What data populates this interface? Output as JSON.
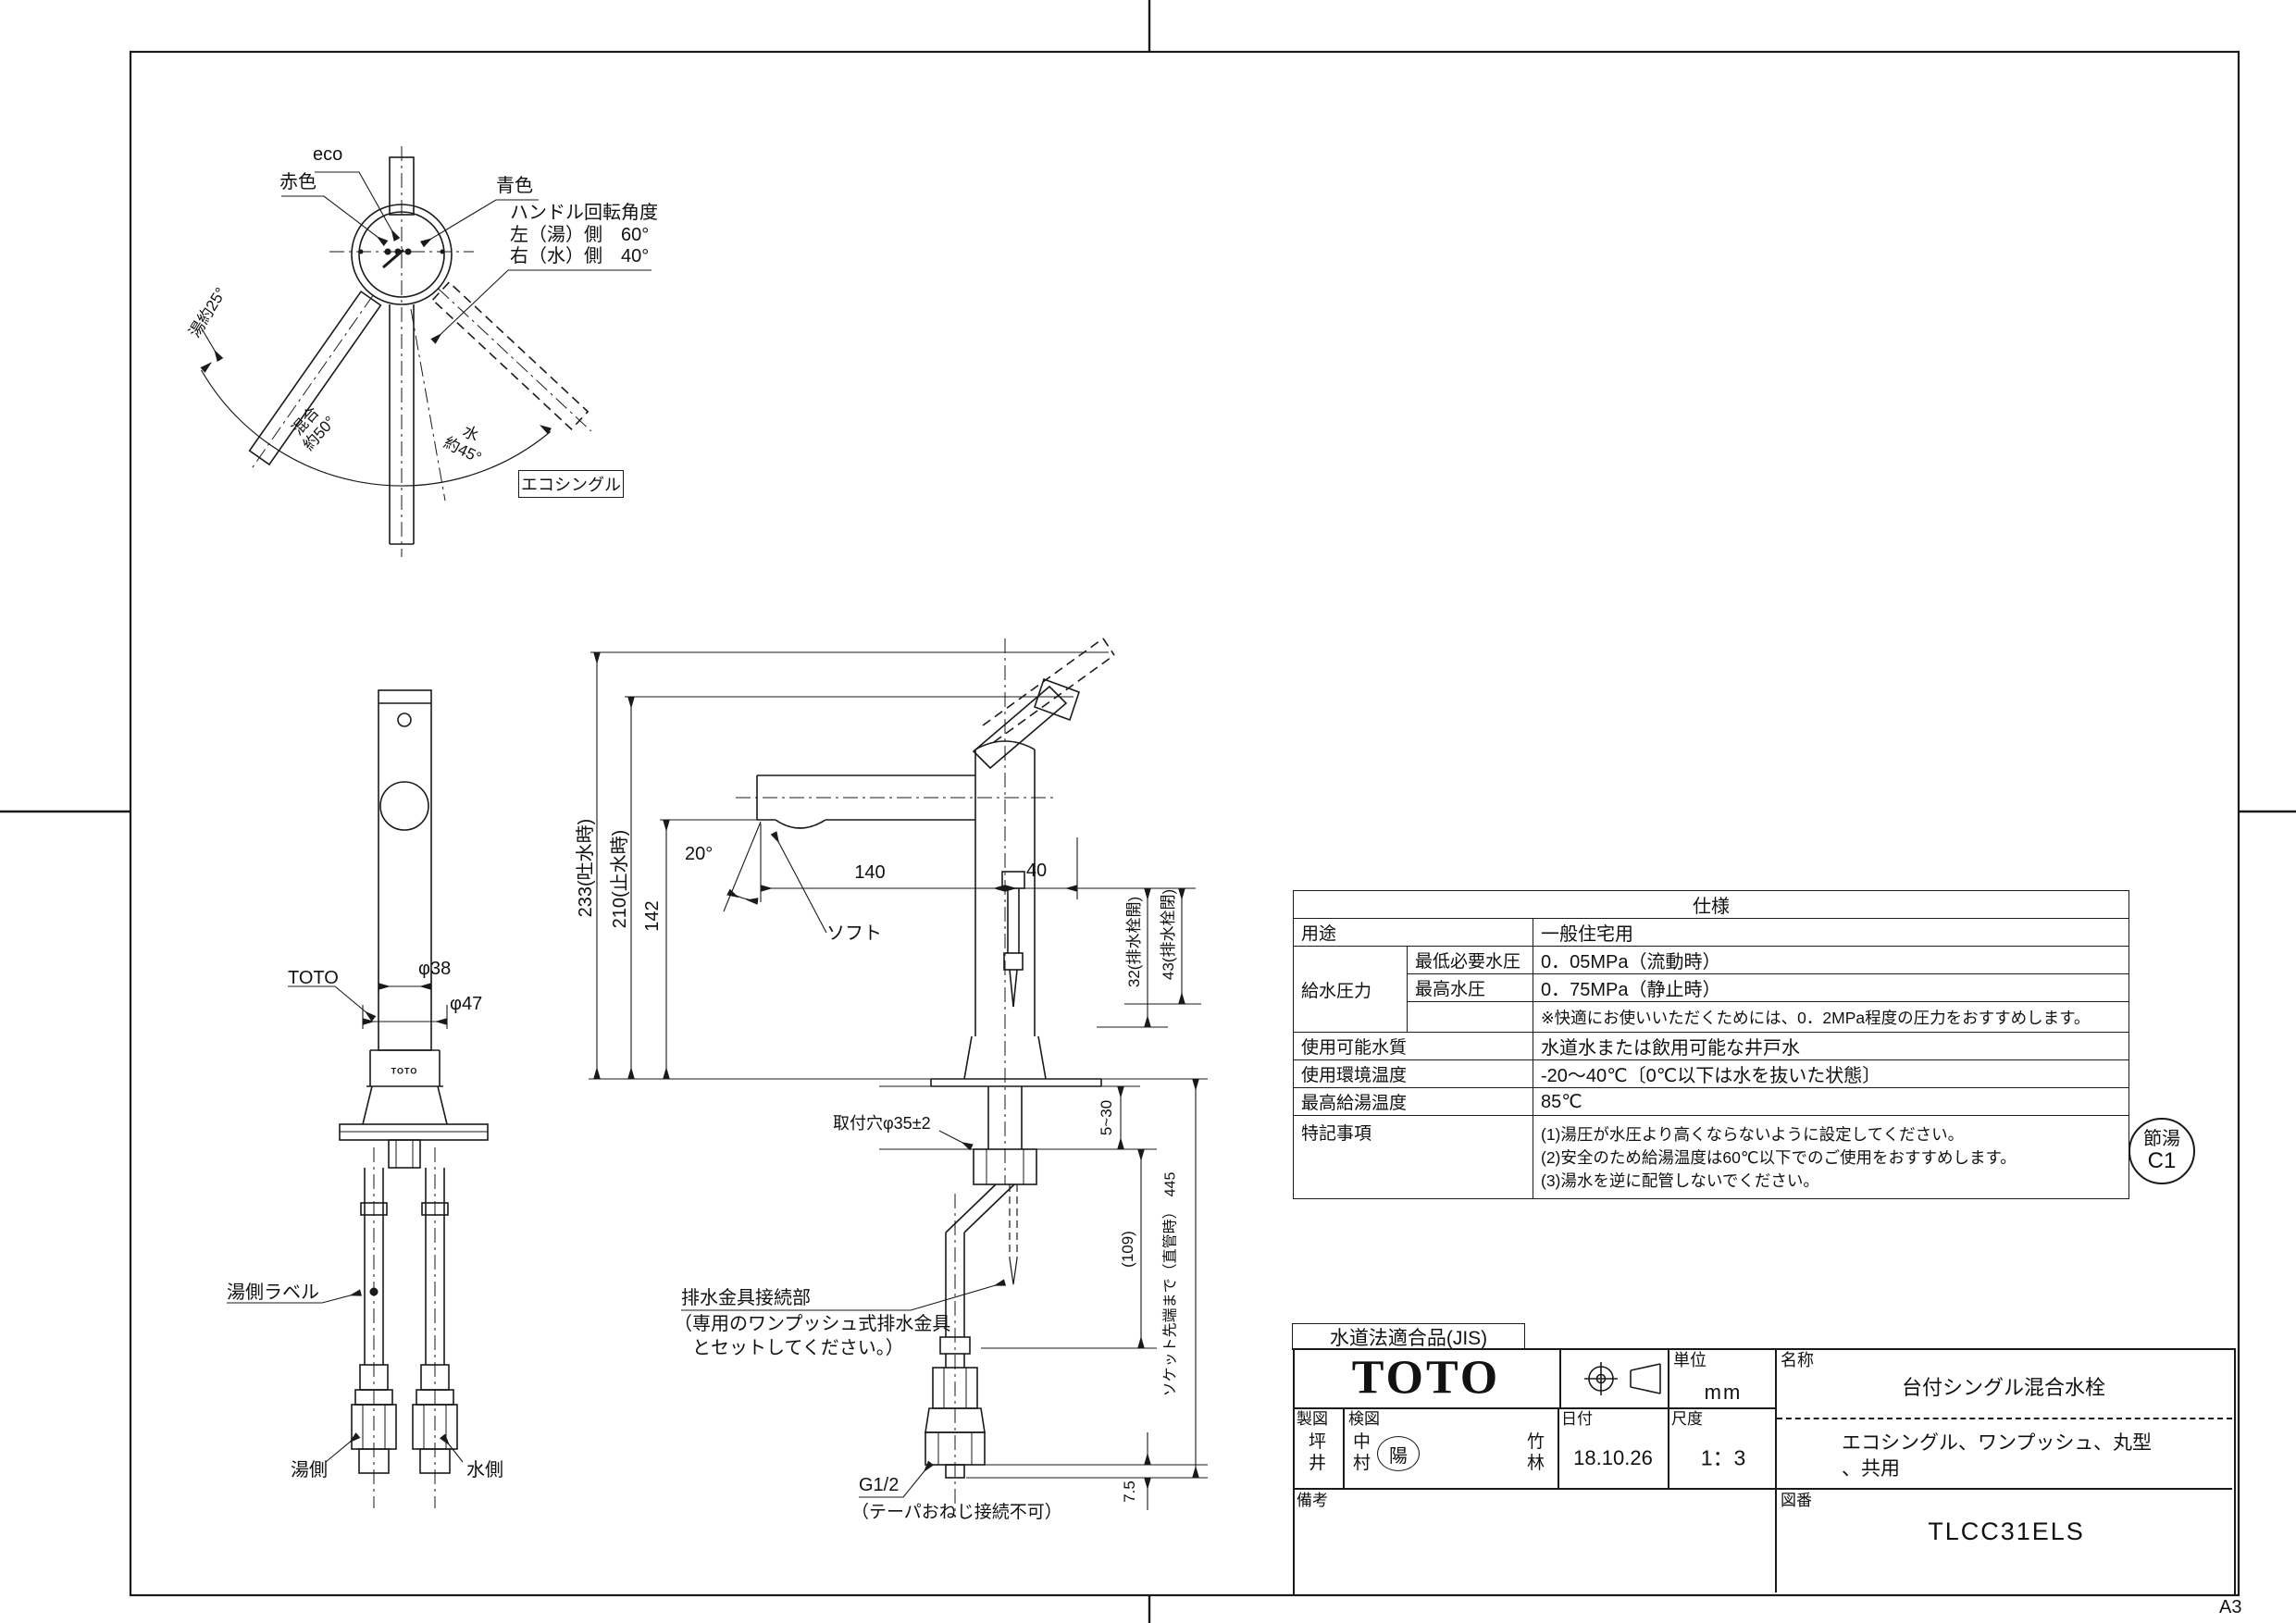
{
  "sheet": {
    "size_label": "A3"
  },
  "handle_diagram": {
    "eco": "eco",
    "red": "赤色",
    "blue": "青色",
    "rotation_title": "ハンドル回転角度",
    "rotation_left": "左（湯）側　60°",
    "rotation_right": "右（水）側　40°",
    "arc_hot": "湯約25°",
    "arc_mix": "混合\n約50°",
    "arc_water": "水\n約45°",
    "mode_box": "エコシングル"
  },
  "front_view": {
    "toto_callout": "TOTO",
    "dia38": "φ38",
    "dia47": "φ47",
    "body_logo": "TOTO",
    "hot_label_note": "湯側ラベル",
    "hot_side": "湯側",
    "water_side": "水側"
  },
  "side_view": {
    "d233": "233(吐水時)",
    "d210": "210(止水時)",
    "d142": "142",
    "a20": "20°",
    "soft": "ソフト",
    "d140": "140",
    "d40": "40",
    "d32": "32(排水栓開)",
    "d43": "43(排水栓閉)",
    "d5_30": "5~30",
    "d109": "(109)",
    "d445": "ソケット先端まで（直管時）　445",
    "d75": "7.5",
    "mount_hole": "取付穴φ35±2",
    "drain1": "排水金具接続部",
    "drain2": "（専用のワンプッシュ式排水金具",
    "drain3": "　とセットしてください。）",
    "g12": "G1/2",
    "g12_note": "（テーパおねじ接続不可）"
  },
  "spec_table": {
    "title": "仕様",
    "usage_label": "用途",
    "usage": "一般住宅用",
    "pressure_label": "給水圧力",
    "min_label": "最低必要水圧",
    "min": "0．05MPa（流動時）",
    "max_label": "最高水圧",
    "max": "0．75MPa（静止時）",
    "note": "※快適にお使いいただくためには、0．2MPa程度の圧力をおすすめします。",
    "quality_label": "使用可能水質",
    "quality": "水道水または飲用可能な井戸水",
    "env_label": "使用環境温度",
    "env": "-20～40℃〔0℃以下は水を抜いた状態〕",
    "hotmax_label": "最高給湯温度",
    "hotmax": "85℃",
    "notes_label": "特記事項",
    "note1": "(1)湯圧が水圧より高くならないように設定してください。",
    "note2": "(2)安全のため給湯温度は60℃以下でのご使用をおすすめします。",
    "note3": "(3)湯水を逆に配管しないでください。"
  },
  "badge": {
    "line1": "節湯",
    "line2": "C1"
  },
  "title_block": {
    "jis": "水道法適合品(JIS)",
    "brand": "TOTO",
    "unit_label": "単位",
    "unit": "mm",
    "name_label": "名称",
    "name1": "台付シングル混合水栓",
    "name2": "エコシングル、ワンプッシュ、丸型",
    "name3": "、共用",
    "drafter_label": "製図",
    "drafter": "坪\n井",
    "checker_label": "検図",
    "checker1": "中\n村",
    "checker_stamp": "陽",
    "checker2": "竹\n林",
    "date_label": "日付",
    "date": "18.10.26",
    "scale_label": "尺度",
    "scale": "1：3",
    "remarks_label": "備考",
    "number_label": "図番",
    "number": "TLCC31ELS"
  }
}
